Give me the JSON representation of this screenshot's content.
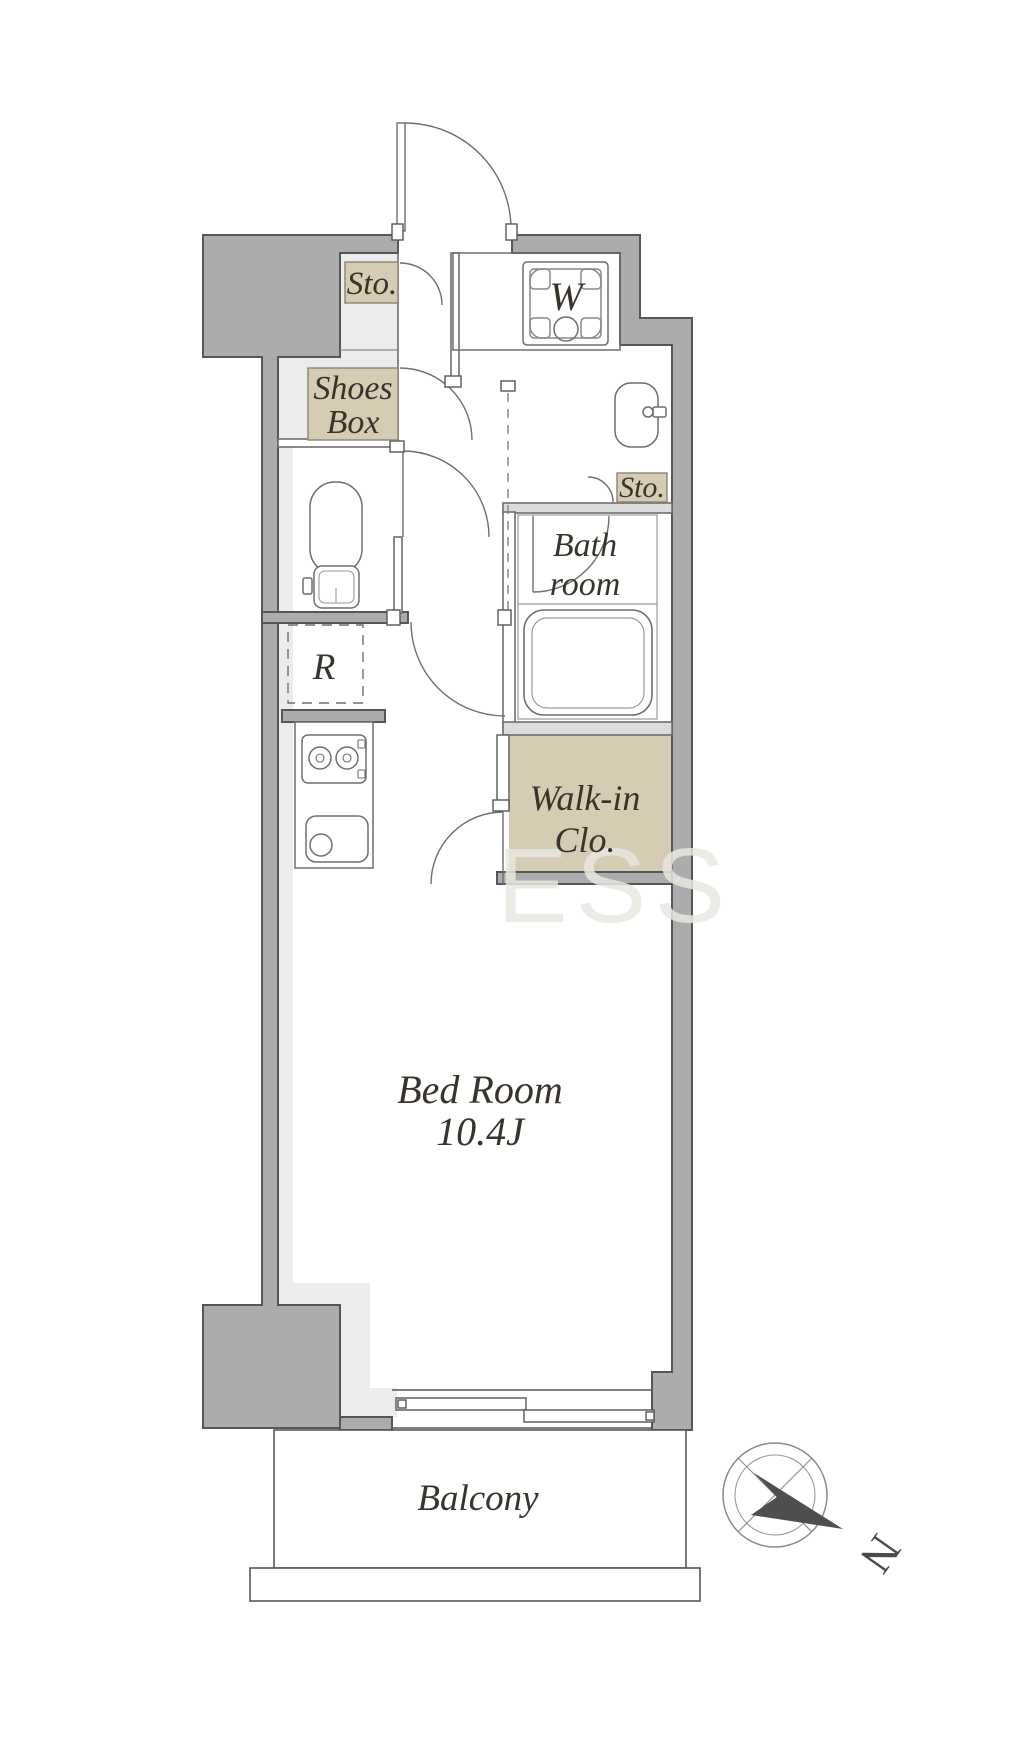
{
  "colors": {
    "wall_fill": "#acacac",
    "wall_outline": "#55565a",
    "floor_light": "#ececec",
    "closet_tan": "#d5ccb3",
    "label_text": "#38342c",
    "fixture_line": "#6e6e6e",
    "compass_needle": "#4f4f4f",
    "watermark": "#e9e7e0"
  },
  "labels": {
    "storage_entry": "Sto.",
    "shoes_box_line1": "Shoes",
    "shoes_box_line2": "Box",
    "washing_machine": "W",
    "storage_bath": "Sto.",
    "bathroom_line1": "Bath",
    "bathroom_line2": "room",
    "walk_in_closet_line1": "Walk-in",
    "walk_in_closet_line2": "Clo.",
    "refrigerator": "R",
    "bedroom_name": "Bed Room",
    "bedroom_size": "10.4J",
    "balcony": "Balcony",
    "compass_north": "N"
  },
  "watermark_text": "ESS"
}
